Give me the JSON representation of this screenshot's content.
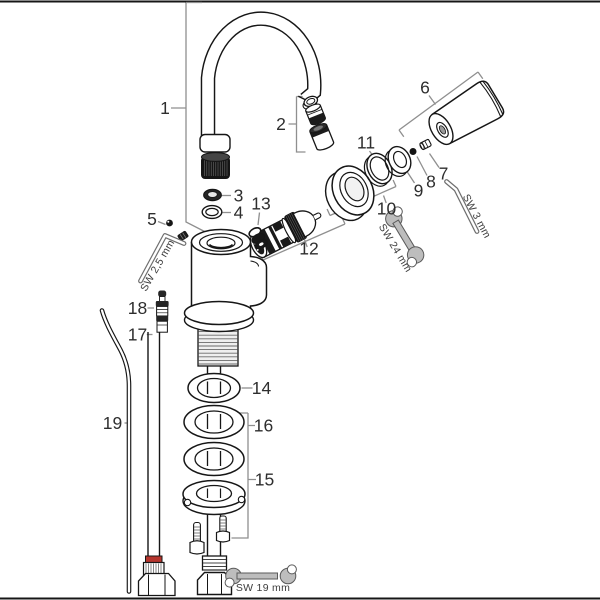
{
  "diagram": {
    "part_labels": {
      "n1": "1",
      "n2": "2",
      "n3": "3",
      "n4": "4",
      "n5": "5",
      "n6": "6",
      "n7": "7",
      "n8": "8",
      "n9": "9",
      "n10": "10",
      "n11": "11",
      "n12": "12",
      "n13": "13",
      "n14": "14",
      "n15": "15",
      "n16": "16",
      "n17": "17",
      "n18": "18",
      "n19": "19"
    },
    "tool_labels": {
      "allen_key_2_5": "SW 2,5 mm",
      "allen_key_3": "SW 3 mm",
      "wrench_24": "SW 24 mm",
      "wrench_19": "SW 19 mm"
    },
    "colors": {
      "line": "#161616",
      "leader": "#8f8f8f",
      "label_text": "#2e2e2e",
      "tool_fill": "#bdbdbd",
      "tool_stroke": "#5a5a5a",
      "hose_band_red": "#b5342c",
      "background": "#ffffff"
    }
  }
}
